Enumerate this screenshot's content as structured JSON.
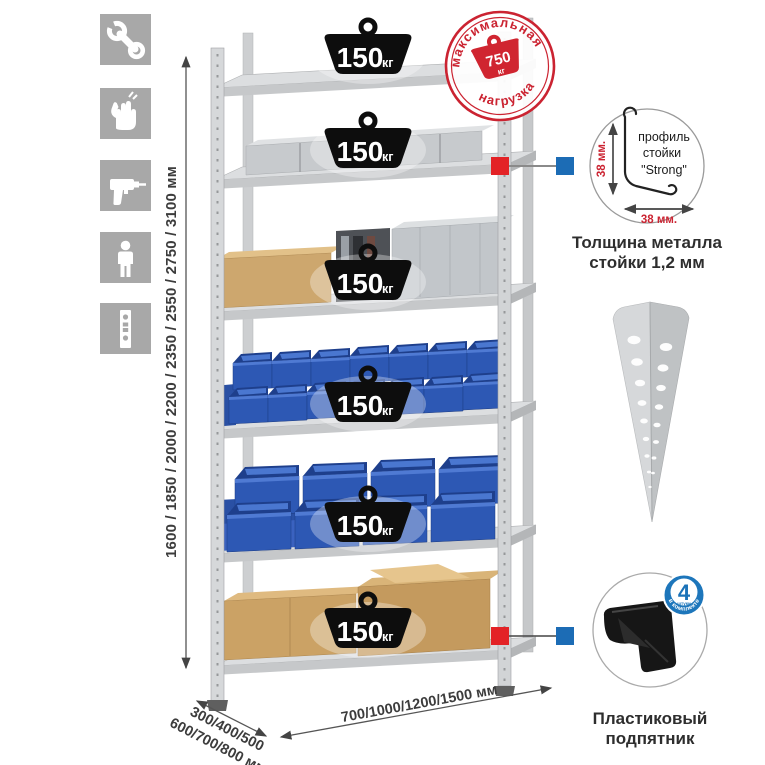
{
  "colors": {
    "accent_red": "#cb2331",
    "marker_red": "#e32226",
    "marker_blue": "#1c6cb5",
    "badge_blue": "#1d76bb",
    "bin_blue": "#2d58b4",
    "icon_bg_gray": "#a8a8a8",
    "metal_gray": "#d3d5d7",
    "weight_black": "#0d0d0d"
  },
  "left_icons": {
    "items": [
      {
        "name": "wrench-icon"
      },
      {
        "name": "gloves-icon"
      },
      {
        "name": "drill-icon"
      },
      {
        "name": "person-icon"
      },
      {
        "name": "rack-post-icon"
      }
    ]
  },
  "height_dimension": {
    "label": "1600 / 1850 / 2000 / 2200 / 2350 / 2550 / 2750 / 3100 мм"
  },
  "depth_dimension": {
    "line1": "300/400/500",
    "line2": "600/700/800 мм"
  },
  "width_dimension": {
    "label": "700/1000/1200/1500 мм"
  },
  "rack": {
    "shelf_count": 6,
    "shelf_load": {
      "value": "150",
      "unit": "кг"
    }
  },
  "max_load_stamp": {
    "arc_top": "максимальная",
    "arc_bottom": "нагрузка",
    "value": "750",
    "unit": "кг"
  },
  "profile_detail": {
    "label_line1": "профиль",
    "label_line2": "стойки",
    "label_line3": "\"Strong\"",
    "dim_vertical": "38 мм.",
    "dim_horizontal": "38 мм.",
    "caption_line1": "Толщина металла",
    "caption_line2": "стойки 1,2 мм"
  },
  "foot_detail": {
    "badge_value": "4",
    "badge_unit": "штуки",
    "badge_arc": "в комплекте",
    "caption_line1": "Пластиковый",
    "caption_line2": "подпятник"
  }
}
